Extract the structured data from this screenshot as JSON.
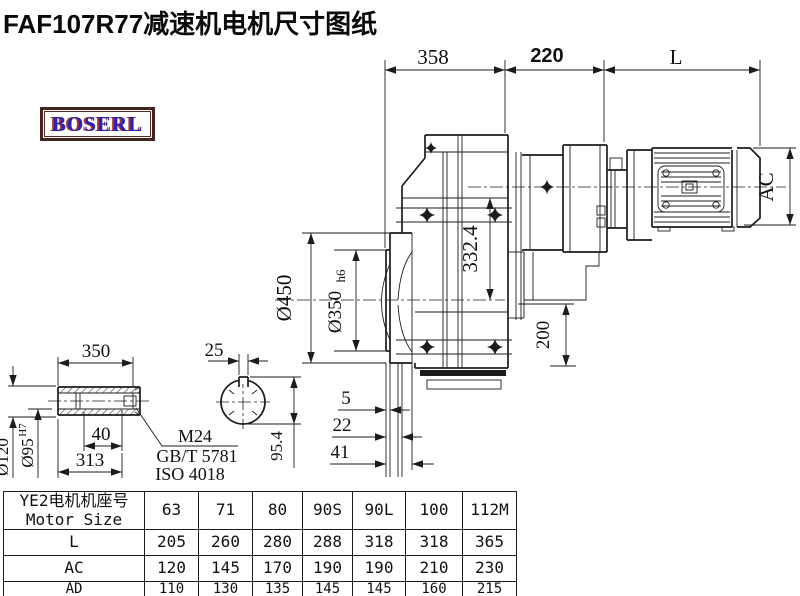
{
  "title": "FAF107R77减速机电机尺寸图纸",
  "logo": {
    "text": "BOSERL"
  },
  "colors": {
    "line": "#1c1c1c",
    "logo_border": "#47231d",
    "logo_text": "#2323bb",
    "logo_shadow": "#b03333"
  },
  "drawing": {
    "dims": {
      "d358": "358",
      "d220": "220",
      "dL": "L",
      "dAC": "AC",
      "d332": "332.4",
      "d450": "Ø450",
      "d350": "Ø350",
      "d350tol": "h6",
      "d200": "200",
      "d5": "5",
      "d22": "22",
      "d41": "41",
      "d350b": "350",
      "d25": "25",
      "d120": "Ø120",
      "d95": "Ø95",
      "d95tol": "H7",
      "d40": "40",
      "d313": "313",
      "d954": "95.4",
      "thread": "M24",
      "std1": "GB/T 5781",
      "std2": "ISO 4018"
    }
  },
  "table": {
    "header_cn": "YE2电机机座号",
    "header_en": "Motor Size",
    "sizes": [
      "63",
      "71",
      "80",
      "90S",
      "90L",
      "100",
      "112M"
    ],
    "rows": [
      {
        "label": "L",
        "values": [
          "205",
          "260",
          "280",
          "288",
          "318",
          "318",
          "365"
        ]
      },
      {
        "label": "AC",
        "values": [
          "120",
          "145",
          "170",
          "190",
          "190",
          "210",
          "230"
        ]
      },
      {
        "label": "AD",
        "values": [
          "110",
          "130",
          "135",
          "145",
          "145",
          "160",
          "215"
        ]
      }
    ]
  }
}
